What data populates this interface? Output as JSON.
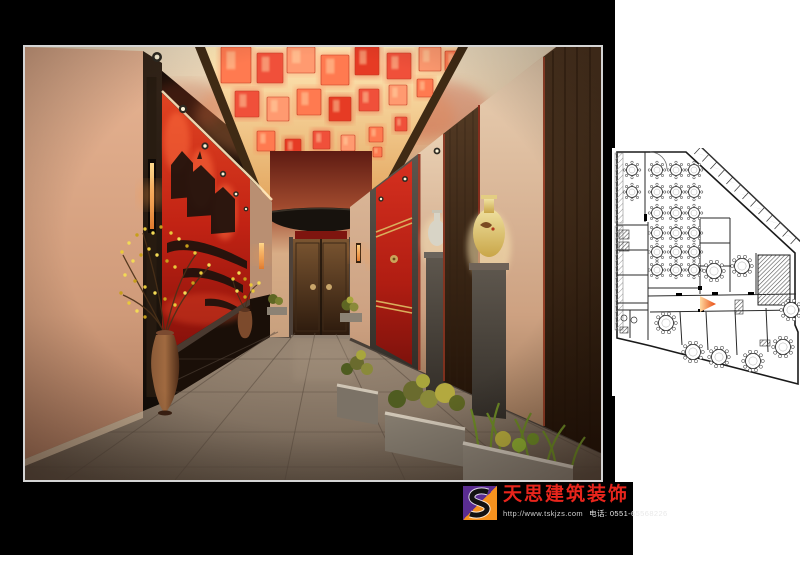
{
  "logo": {
    "company_name": "天思建筑装饰",
    "website": "http://www.tskjzs.com",
    "phone": "电话: 0551-65568226",
    "icon_letter": "S",
    "colors": {
      "purple": "#5a2d91",
      "orange": "#f6921e",
      "red": "#e8251c"
    }
  },
  "rendering": {
    "palette": {
      "wall_peach": "#d99675",
      "feature_red": "#cc2a1d",
      "wood_dark": "#3a2817",
      "lantern_orange": "#ff7a50",
      "floor_gray": "#8a7a6e",
      "stone": "#55504a"
    },
    "lantern_palette": [
      "#ff7a50",
      "#f0503a",
      "#ff9a70",
      "#e63b24",
      "#ffb48c"
    ],
    "lanterns": [
      [
        196,
        0,
        30,
        36,
        0
      ],
      [
        232,
        6,
        26,
        30,
        1
      ],
      [
        262,
        0,
        28,
        26,
        2
      ],
      [
        296,
        8,
        28,
        30,
        0
      ],
      [
        330,
        0,
        24,
        28,
        3
      ],
      [
        362,
        6,
        24,
        26,
        1
      ],
      [
        394,
        0,
        22,
        24,
        2
      ],
      [
        420,
        4,
        18,
        20,
        0
      ],
      [
        210,
        44,
        24,
        26,
        1
      ],
      [
        242,
        50,
        22,
        24,
        2
      ],
      [
        272,
        42,
        24,
        26,
        0
      ],
      [
        304,
        50,
        22,
        24,
        3
      ],
      [
        334,
        42,
        20,
        22,
        1
      ],
      [
        364,
        38,
        18,
        20,
        2
      ],
      [
        392,
        32,
        16,
        18,
        0
      ],
      [
        232,
        84,
        18,
        20,
        0
      ],
      [
        260,
        92,
        16,
        18,
        3
      ],
      [
        288,
        84,
        17,
        18,
        1
      ],
      [
        316,
        88,
        14,
        16,
        2
      ],
      [
        344,
        80,
        14,
        15,
        0
      ],
      [
        370,
        70,
        12,
        14,
        1
      ],
      [
        252,
        118,
        12,
        14,
        2
      ],
      [
        276,
        122,
        12,
        13,
        0
      ],
      [
        300,
        116,
        11,
        12,
        3
      ],
      [
        324,
        110,
        10,
        11,
        1
      ],
      [
        348,
        100,
        9,
        10,
        0
      ],
      [
        268,
        142,
        9,
        10,
        1
      ],
      [
        288,
        146,
        8,
        9,
        0
      ],
      [
        308,
        138,
        8,
        9,
        2
      ],
      [
        292,
        160,
        6,
        8,
        0
      ],
      [
        304,
        163,
        5,
        7,
        3
      ]
    ],
    "lanterns_free": [
      [
        288,
        170,
        7,
        8,
        0
      ],
      [
        300,
        176,
        6,
        7,
        2
      ],
      [
        294,
        188,
        5,
        6,
        1
      ]
    ],
    "blossom_colors": [
      "#e9c93a",
      "#f3da55",
      "#c79f1a"
    ],
    "blossoms": [
      [
        97,
        205
      ],
      [
        104,
        196
      ],
      [
        112,
        188
      ],
      [
        120,
        182
      ],
      [
        128,
        186
      ],
      [
        136,
        180
      ],
      [
        146,
        186
      ],
      [
        154,
        192
      ],
      [
        162,
        199
      ],
      [
        170,
        206
      ],
      [
        108,
        214
      ],
      [
        116,
        208
      ],
      [
        124,
        202
      ],
      [
        132,
        208
      ],
      [
        142,
        214
      ],
      [
        150,
        220
      ],
      [
        100,
        228
      ],
      [
        110,
        234
      ],
      [
        120,
        240
      ],
      [
        130,
        246
      ],
      [
        140,
        252
      ],
      [
        150,
        258
      ],
      [
        160,
        246
      ],
      [
        168,
        236
      ],
      [
        176,
        226
      ],
      [
        184,
        218
      ],
      [
        96,
        246
      ],
      [
        104,
        256
      ],
      [
        112,
        264
      ],
      [
        120,
        270
      ],
      [
        208,
        232
      ],
      [
        214,
        226
      ],
      [
        220,
        232
      ],
      [
        226,
        238
      ],
      [
        212,
        244
      ],
      [
        220,
        250
      ],
      [
        228,
        244
      ],
      [
        234,
        236
      ]
    ]
  },
  "floor_plan": {
    "outline": "M617,152 L686,152 L795,253 L795,325 L798,332 L798,384 L651,346 L617,338 Z",
    "walls": [
      "M645,152 L645,222",
      "M617,225 L648,225",
      "M648,222 L648,290",
      "M617,250 L648,250",
      "M617,275 L648,275",
      "M617,303 L648,303",
      "M617,310 L648,310",
      "M630,310 L630,338",
      "M648,288 L700,288",
      "M700,218 L700,294",
      "M730,218 L730,292",
      "M700,218 L730,218",
      "M700,243 L730,243",
      "M700,266 L730,266",
      "M756,253 L756,294",
      "M648,296 L796,294",
      "M650,312 L796,310",
      "M648,290 L648,340",
      "M680,312 L682,345",
      "M706,312 L708,350",
      "M735,310 L737,355",
      "M766,308 L768,352"
    ],
    "fixtures": [
      [
        619,
        230,
        10,
        9
      ],
      [
        619,
        242,
        10,
        9
      ],
      [
        620,
        327,
        8,
        6
      ],
      [
        735,
        300,
        8,
        14
      ],
      [
        760,
        340,
        10,
        6
      ]
    ],
    "stage": [
      758,
      255,
      32,
      50
    ],
    "entrance_arc": "M650,152 A17,17 0 0 1 667,169",
    "band": {
      "inner": [
        690,
        150,
        797,
        250
      ],
      "outer": [
        698,
        144,
        802,
        243
      ],
      "bowties": 7,
      "ticks": 13
    },
    "banquet_tables": {
      "r": 5.5,
      "chair_r": 1.2,
      "chairs": 8,
      "centers": [
        [
          632,
          170
        ],
        [
          632,
          192
        ],
        [
          657,
          170
        ],
        [
          657,
          192
        ],
        [
          657,
          213
        ],
        [
          657,
          233
        ],
        [
          657,
          252
        ],
        [
          657,
          270
        ],
        [
          676,
          170
        ],
        [
          676,
          192
        ],
        [
          676,
          213
        ],
        [
          676,
          233
        ],
        [
          676,
          252
        ],
        [
          676,
          270
        ],
        [
          694,
          170
        ],
        [
          694,
          192
        ],
        [
          694,
          213
        ],
        [
          694,
          233
        ],
        [
          694,
          252
        ],
        [
          694,
          270
        ]
      ]
    },
    "private_tables": {
      "r": 7.5,
      "chair_r": 1.6,
      "chairs": 10,
      "centers": [
        [
          714,
          271
        ],
        [
          742,
          266
        ],
        [
          666,
          323
        ],
        [
          693,
          352
        ],
        [
          719,
          357
        ],
        [
          753,
          361
        ],
        [
          783,
          347
        ],
        [
          791,
          310
        ]
      ]
    },
    "marker": {
      "points": "700,296 716,304 700,312",
      "color1": "#ffb24d",
      "color2": "#e8490f"
    }
  }
}
